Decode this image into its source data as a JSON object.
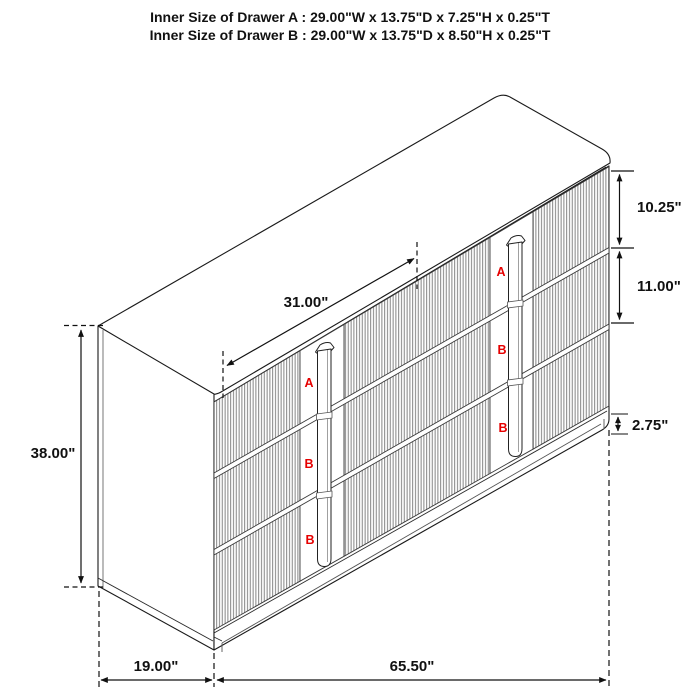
{
  "title": {
    "line1": "Inner Size of Drawer A : 29.00\"W x 13.75\"D x 7.25\"H x 0.25\"T",
    "line2": "Inner Size of Drawer B : 29.00\"W x 13.75\"D x 8.50\"H x 0.25\"T"
  },
  "diagram": {
    "side_dimension": "38.00\"",
    "top_dimension": "31.00\"",
    "right_dimensions": {
      "drawer_a": "10.25\"",
      "drawer_b": "11.00\"",
      "base": "2.75\""
    },
    "bottom_dimensions": {
      "depth": "19.00\"",
      "width": "65.50\""
    },
    "drawer_markers": {
      "left_column": [
        "A",
        "B",
        "B"
      ],
      "right_column": [
        "A",
        "B",
        "B"
      ]
    }
  },
  "colors": {
    "line": "#1a1a1a",
    "flute_line": "#777777",
    "marker_red": "#e60000",
    "background": "#ffffff"
  }
}
